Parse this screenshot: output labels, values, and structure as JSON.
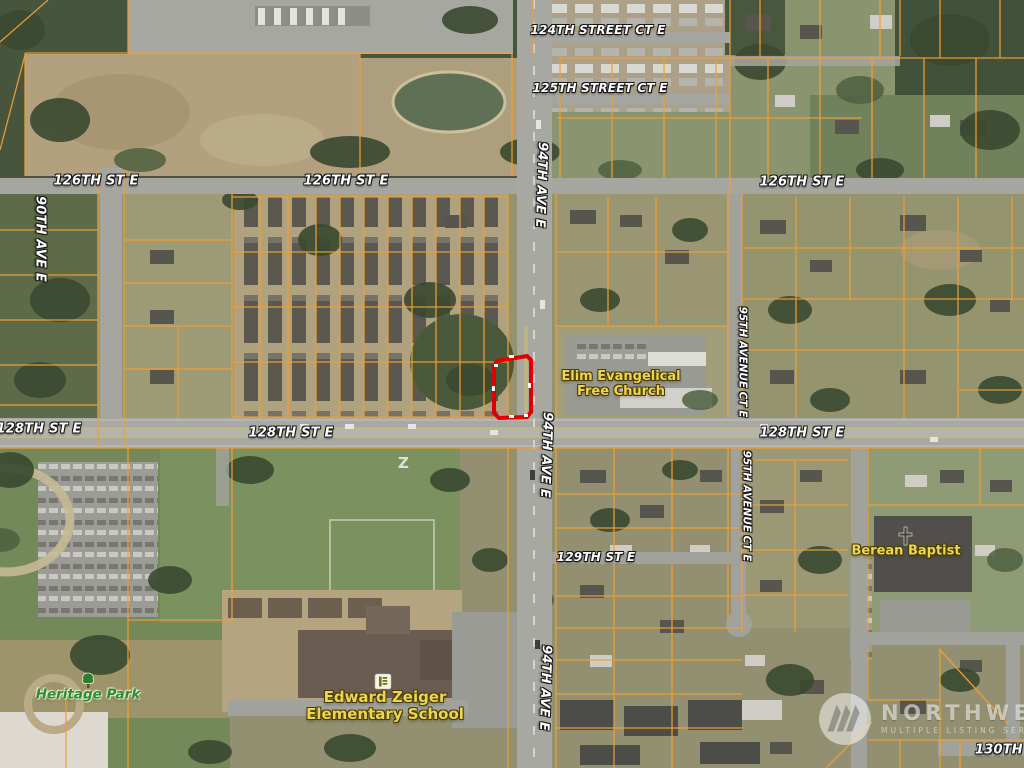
{
  "map": {
    "field_marking": "Z",
    "street_labels": [
      {
        "text": "124TH STREET CT E"
      },
      {
        "text": "125TH STREET CT E"
      },
      {
        "text": "126TH ST E"
      },
      {
        "text": "126TH ST E"
      },
      {
        "text": "126TH ST E"
      },
      {
        "text": "128TH ST E"
      },
      {
        "text": "128TH ST E"
      },
      {
        "text": "128TH ST E"
      },
      {
        "text": "129TH ST E"
      },
      {
        "text": "130TH STR"
      },
      {
        "text": "90TH AVE E"
      },
      {
        "text": "94TH AVE E"
      },
      {
        "text": "94TH AVE E"
      },
      {
        "text": "94TH AVE E"
      },
      {
        "text": "95TH AVENUE CT E"
      },
      {
        "text": "95TH AVENUE CT E"
      }
    ],
    "pois": {
      "church": {
        "line1": "Elim Evangelical",
        "line2": "Free Church"
      },
      "berean": {
        "name": "Berean Baptist"
      },
      "school": {
        "line1": "Edward Zeiger",
        "line2": "Elementary School"
      },
      "park": {
        "name": "Heritage Park"
      }
    },
    "highlight_parcel": {
      "color": "#e10000"
    },
    "colors": {
      "parcel_line": "#ef9f35",
      "road_label": "#ffffff",
      "poi_label": "#ecd64f",
      "park_label": "#2f8b2f"
    }
  },
  "watermark": {
    "name": "NORTHWEST",
    "tagline": "MULTIPLE LISTING SERVICE"
  }
}
